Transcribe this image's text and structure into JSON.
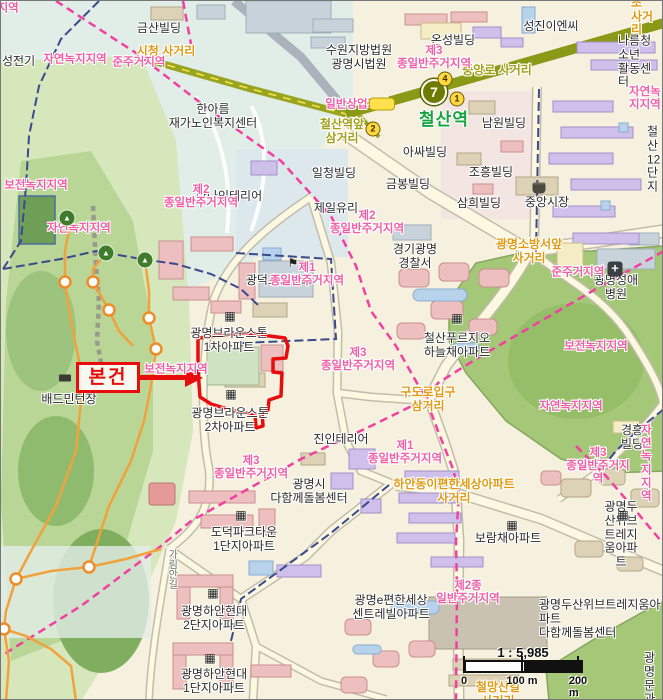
{
  "marker": {
    "label": "본건"
  },
  "station": {
    "line": "7",
    "name": "철산역",
    "exit1": "1",
    "exit2": "2",
    "exit4": "4"
  },
  "scale": {
    "ratio": "1 : 5,985",
    "t0": "0",
    "t100": "100 m",
    "t200": "200 m"
  },
  "icons": {
    "building": "▦",
    "school": "⚑",
    "hospital": "+",
    "tree": "▲"
  },
  "colors": {
    "subject_red": "#e80c0c",
    "zone_pink": "#ef5fa7",
    "intersection_orange": "#e09b13",
    "line7_olive": "#6e7a00",
    "station_green": "#15a53f",
    "boundary_magenta": "#f23fa0",
    "admin_navy": "#3a4a8c",
    "trail_orange": "#f0a23c",
    "park_green": "#a4c878"
  },
  "labels": {
    "buildings": {
      "geumsan": "금산빌딩",
      "court": "수원지방법원\n광명시법원",
      "onseong": "온성빌딩",
      "seongjin": "성진이엔씨",
      "nareum": "나름청소년\n활동센터",
      "hanarum": "한아름\n재가노인복지센터",
      "hanna": "한나인테리어",
      "ilcheong": "일청빌딩",
      "jeilyuri": "제일유리",
      "asa": "아싸빌딩",
      "geumbong": "금봉빌딩",
      "namwon": "남원빌딩",
      "choheung": "조흥빌딩",
      "samhee": "삼희빌딩",
      "market": "중앙시장",
      "cheolsan12": "철산\n12단지",
      "police": "경기광명\n경찰서",
      "hospital": "광명성애병원",
      "prugio": "철산푸르지오\n하늘채아파트",
      "jinin": "진인테리어",
      "gmcare": "광명시\n다함께돌봄센터",
      "dodeok": "도덕파크타운\n1단지아파트",
      "boram": "보람채아파트",
      "doosan": "광명두산위브\n트레지움아파트",
      "hyundai2": "광명하안현대\n2단지아파트",
      "hyundai1": "광명하안현대\n1단지아파트",
      "epyeonhan": "광명e편한세상\n센트레빌아파트",
      "doosancare": "광명두산위브트레지움아파트\n다함께돌봄센터",
      "gyeongheung": "경흥빌딩",
      "braun1": "광명브라운스톤\n1차아파트",
      "braun2": "광명브라운스톤\n2차아파트",
      "badminton": "배드민턴장",
      "gwangdeok": "광덕초등학교",
      "seongjeon": "성전기",
      "gmmun": "광명문\n과대"
    },
    "zones": {
      "frag_left_top": "거지역",
      "jayeon_tl": "자연녹지지역",
      "junju_tl": "준주거지역",
      "j3_top": "제3\n종일반주거지역",
      "ilban_sangeop": "일반상업지역",
      "j2_hanna": "제2\n종일반주거지역",
      "j2_police": "제2\n종일반주거지역",
      "j1_school": "제1\n종일반주거지역",
      "bojeon_left": "보전녹지지역",
      "jayeon_left": "자연녹지지역",
      "bojeon_site": "보전녹지지역",
      "j3_site": "제3\n종일반주거지역",
      "junju_right": "준주거지역",
      "bojeon_right": "보전녹지지역",
      "jayeon_mid": "자연녹지지역",
      "j3_se": "제3\n종일반주거지역",
      "jayeon_se": "자연녹지지역",
      "j3_south": "제3\n종일반주거지역",
      "j1_south": "제1\n종일반주거지역",
      "j2_bottom": "제2종\n일반주거지역",
      "jayeon_ne": "자연녹지지역"
    },
    "intersections": {
      "sicheong": "시청 사거리",
      "jungangno": "중앙로 사거리",
      "cheolsan_ap": "철산역앞\n삼거리",
      "sobang": "광명소방서앞\n사거리",
      "gudoro": "구도로입구\n삼거리",
      "haan": "하안동이편한세상아파트\n사거리",
      "cheolmang": "철망산길\n사거리",
      "ssangseong": "쌍성초\n사거리"
    },
    "roads": {
      "garim": "가림안길"
    }
  }
}
